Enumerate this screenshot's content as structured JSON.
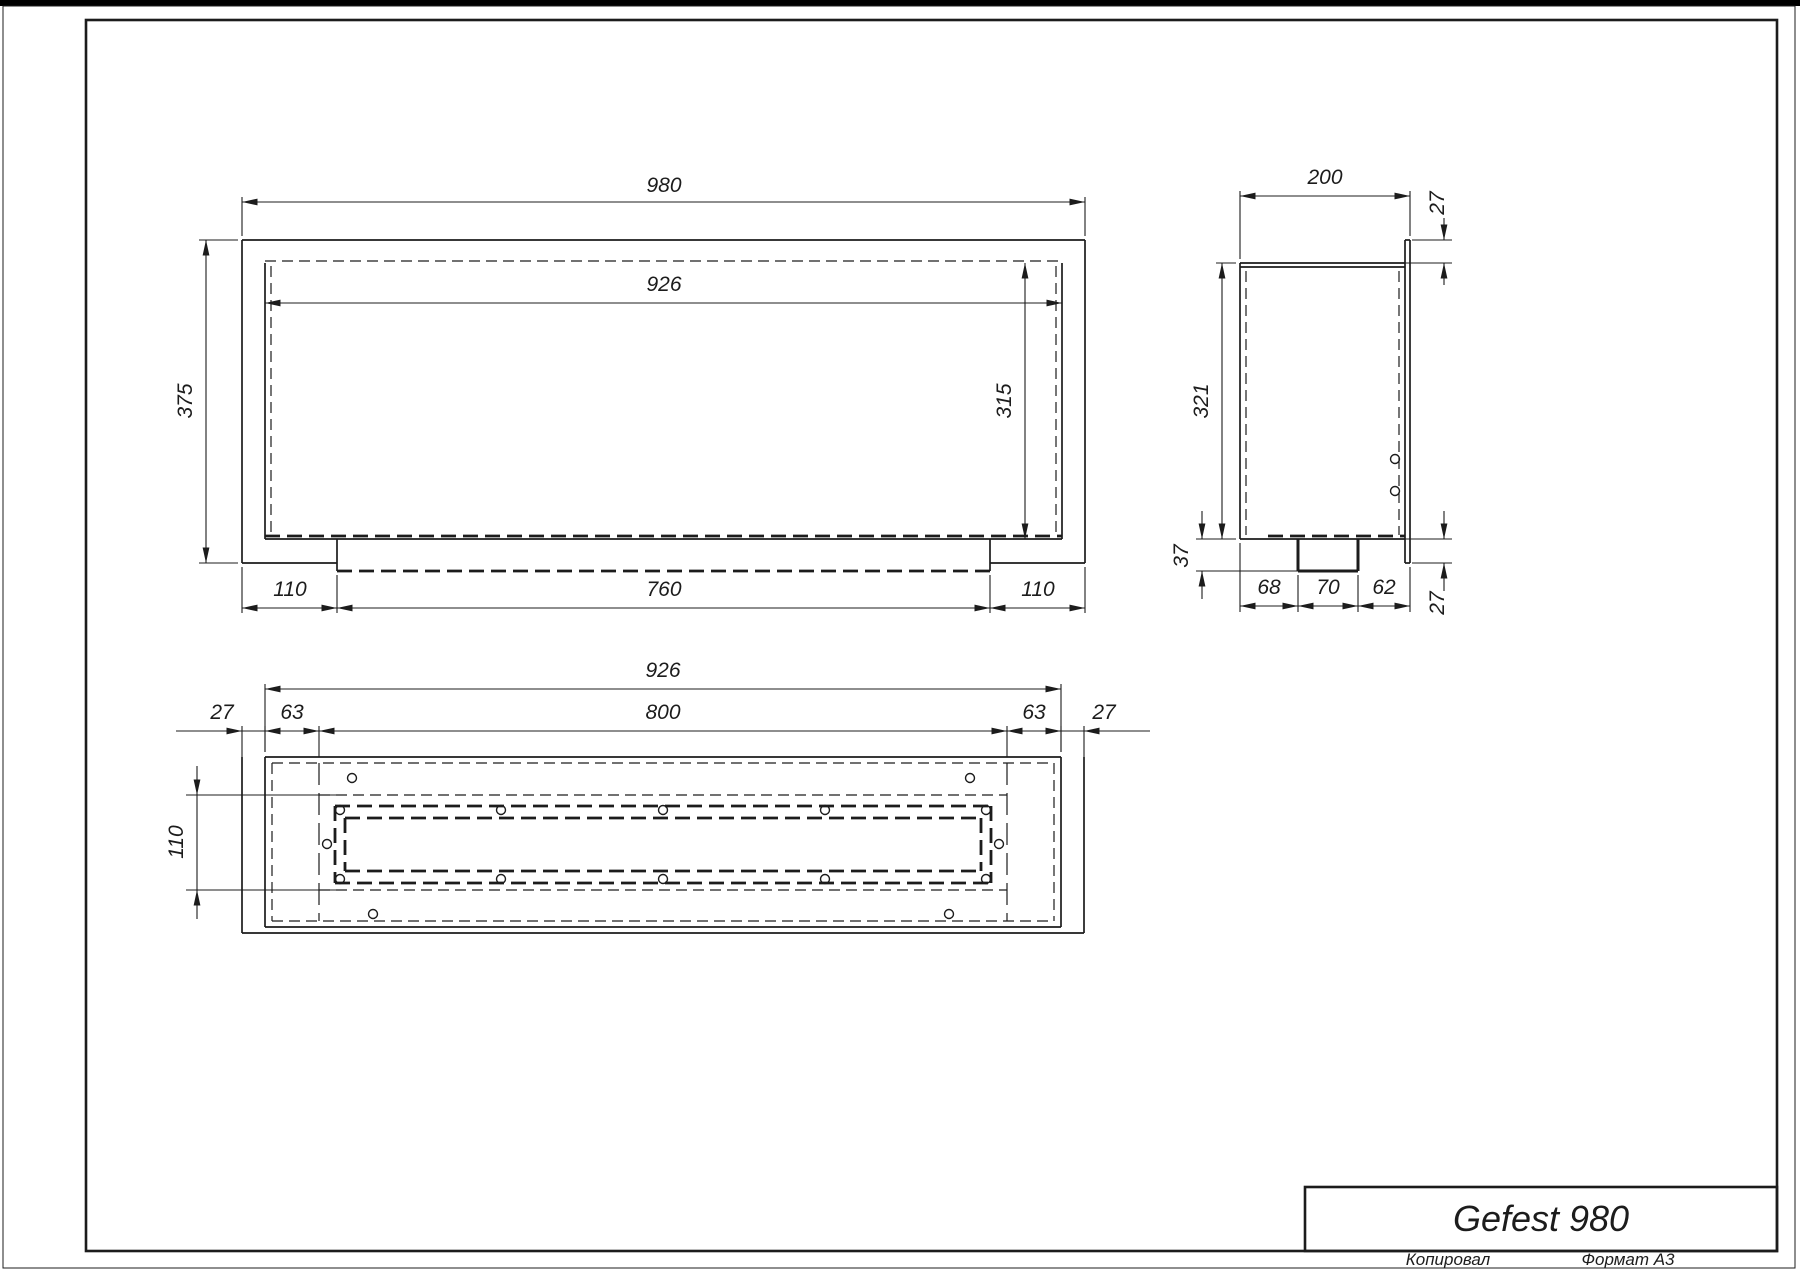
{
  "title_block": {
    "title": "Gefest 980",
    "copied_label": "Копировал",
    "format_label": "Формат А3"
  },
  "views": {
    "front": {
      "dims": {
        "overall_width": "980",
        "opening_width": "926",
        "overall_height": "375",
        "opening_height": "315",
        "bottom_left": "110",
        "tray_width": "760",
        "bottom_right": "110"
      }
    },
    "side": {
      "dims": {
        "depth": "200",
        "flange_top": "27",
        "height": "321",
        "tray_depth": "37",
        "bottom_left": "68",
        "tray_width": "70",
        "bottom_right": "62",
        "flange_bottom": "27"
      }
    },
    "bottom": {
      "dims": {
        "width": "926",
        "flange_left": "27",
        "edge_left": "63",
        "slot_width": "800",
        "edge_right": "63",
        "flange_right": "27",
        "slot_height": "110"
      }
    }
  },
  "colors": {
    "line": "#1c1c1c",
    "background": "#ffffff",
    "top_bar": "#000000"
  }
}
